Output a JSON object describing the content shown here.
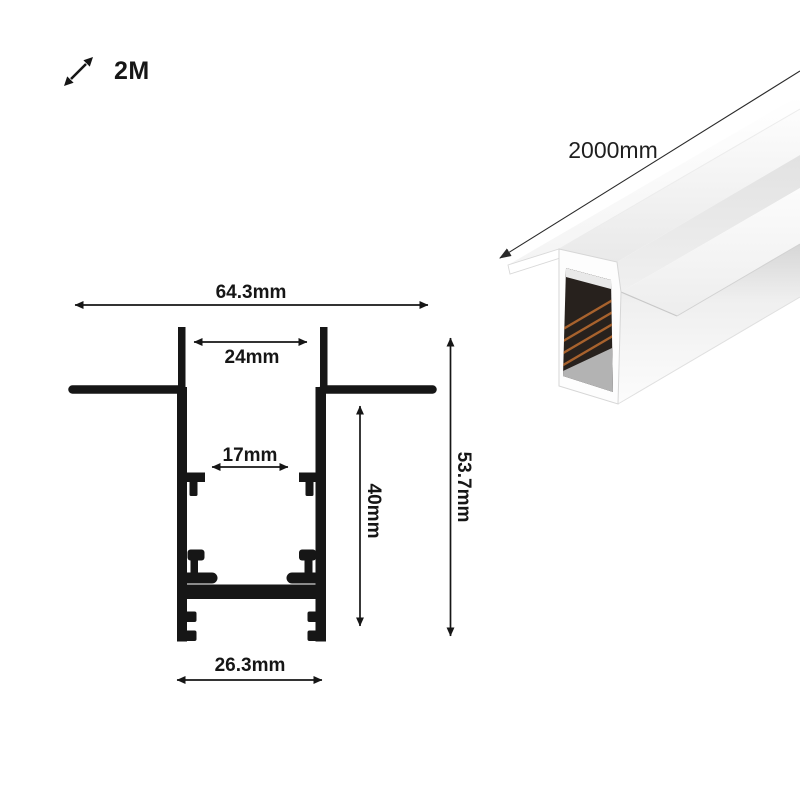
{
  "meta": {
    "type": "product-dimension-sheet",
    "background": "#ffffff",
    "ink_color": "#161616"
  },
  "length_badge": {
    "icon": "diagonal-resize-arrow-icon",
    "label": "2M"
  },
  "render_3d": {
    "description": "White recessed aluminium magnetic track profile shown in 3D perspective",
    "length_dimension": {
      "label": "2000mm"
    },
    "colors": {
      "body": "#ffffff",
      "shading": "#e4e4e4",
      "cavity": "#27211d",
      "conductor_copper": "#a8622d"
    }
  },
  "cross_section": {
    "description": "Cross-section drawing of the profile with dimension callouts",
    "dimensions": {
      "overall_flange_width": {
        "label": "64.3mm"
      },
      "top_opening_width": {
        "label": "24mm"
      },
      "inner_slot_width": {
        "label": "17mm"
      },
      "body_depth": {
        "label": "40mm"
      },
      "overall_height": {
        "label": "53.7mm"
      },
      "body_width": {
        "label": "26.3mm"
      }
    }
  }
}
